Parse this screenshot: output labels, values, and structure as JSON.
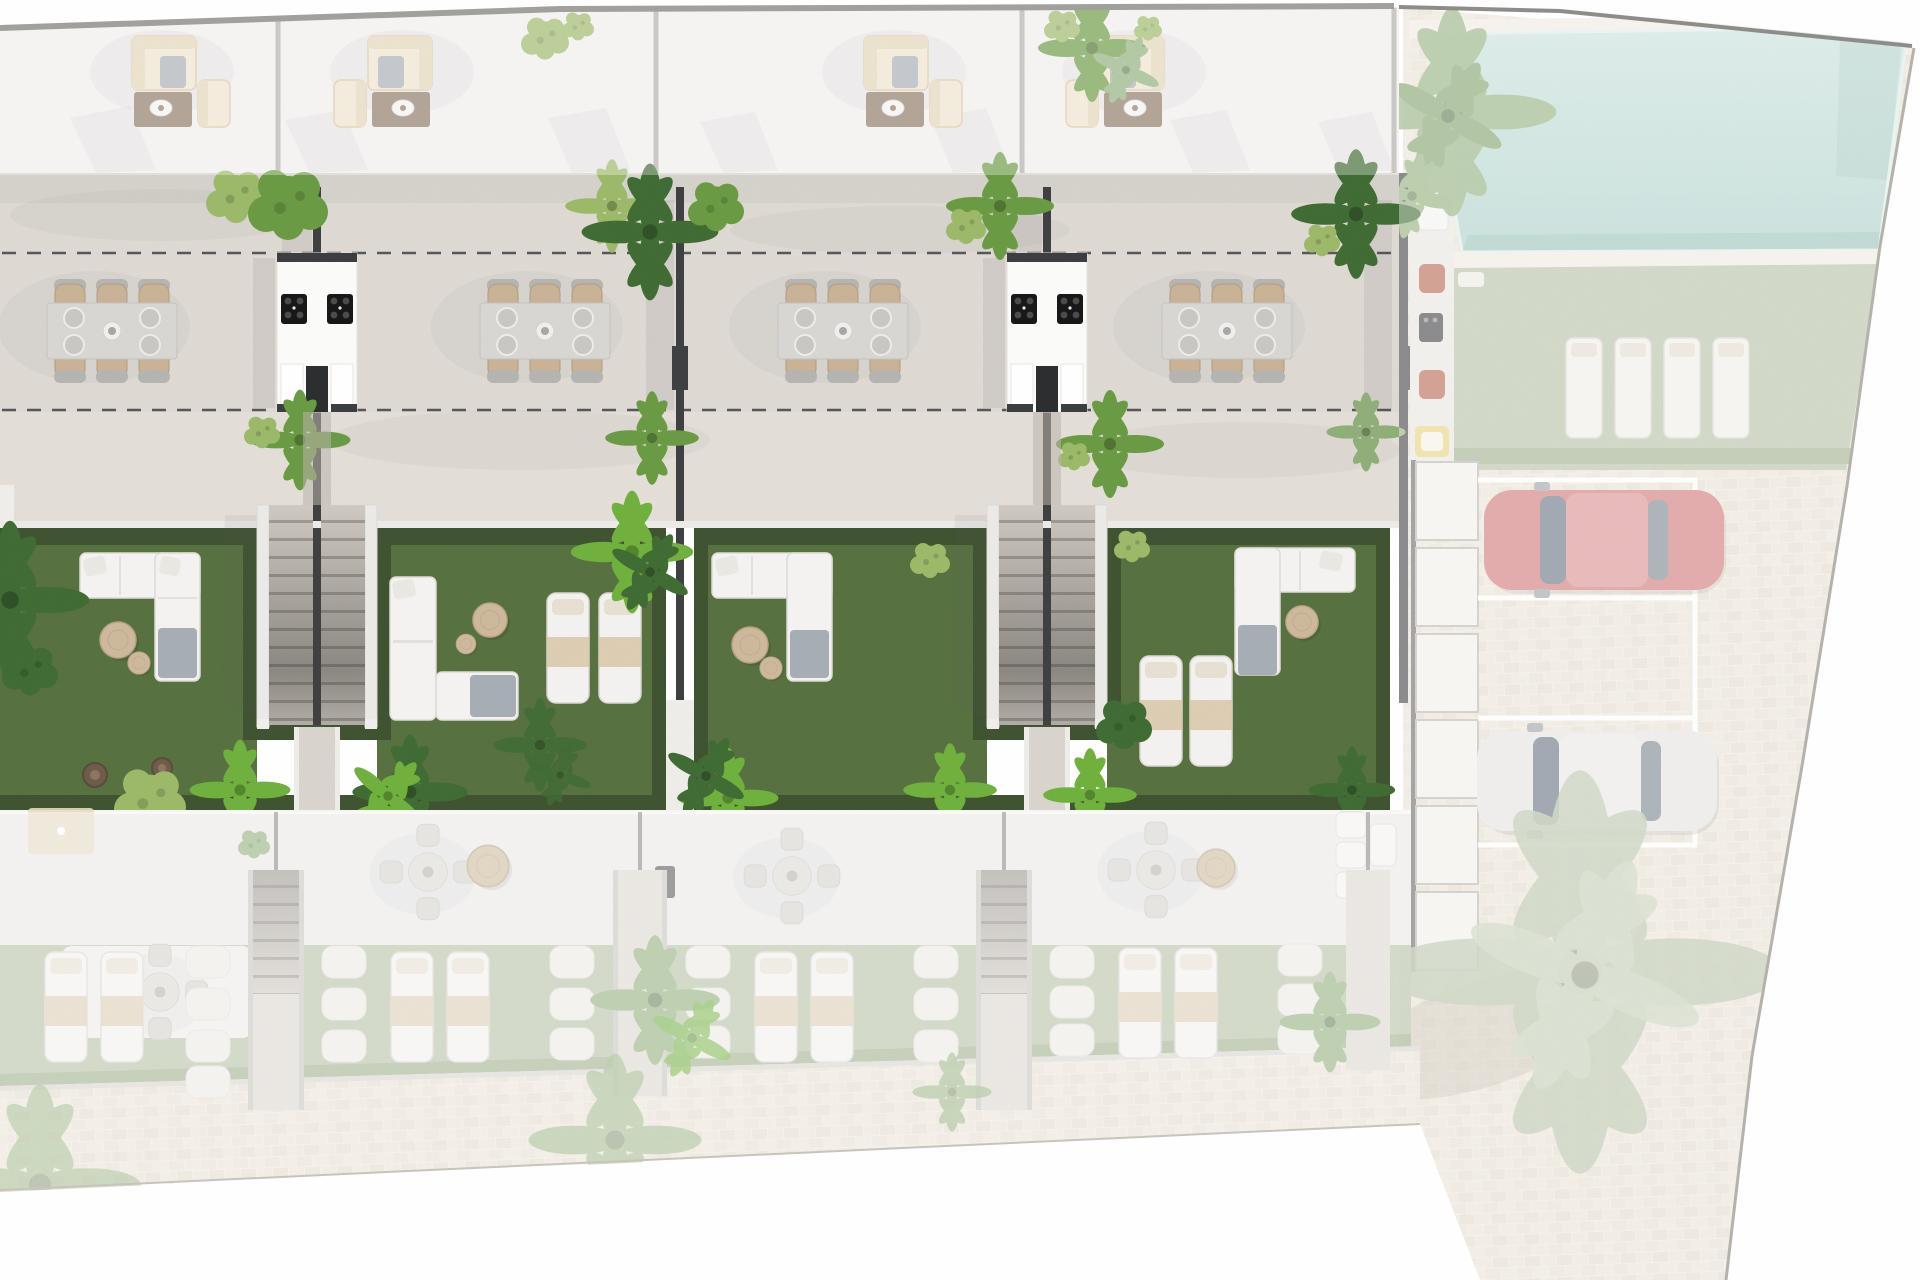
{
  "scene": {
    "type": "architectural site plan, top-down 3D render",
    "focus": "row of townhouse gardens shown in full colour; roof level, neighbouring lower row, pool and parking area shown faded",
    "counts": {
      "townhouse_units_visible": 4,
      "roof_lounge_sets": 4,
      "terrace_dining_sets": 4,
      "chairs_per_dining_set": 6,
      "shared_outdoor_kitchens": 2,
      "garden_staircases": 2,
      "private_gardens": 4,
      "pools": 1,
      "pool_lawn_loungers": 4,
      "parked_cars": 2,
      "parking_bays": 4,
      "lower_row_dining_sets": 4,
      "lower_row_lounger_pairs": 4,
      "storage_boxes": 6
    },
    "cars": [
      {
        "name": "red-car",
        "color_key": "car_red"
      },
      {
        "name": "white-car",
        "color_key": "car_white"
      }
    ]
  },
  "palette": {
    "roof": "#f1efec",
    "terrace": "#ded9d2",
    "terrace_light": "#e3deD7",
    "lawn": "#57703f",
    "hedge": "#3f5230",
    "lawn_pale": "#b6c0a3",
    "hedge_pale": "#9fae8a",
    "pool": "#bcdcd5",
    "pool_deep": "#9cc4bc",
    "paving": "#efe9df",
    "wall_dark": "#3e3f41",
    "line_gray": "#b1afab",
    "dash": "#55555a",
    "white_furniture": "#f4f3f1",
    "beige_seat": "#c9b396",
    "beige_sofa": "#efe5cf",
    "table_gray": "#d8d6d2",
    "coffee_brown": "#8e7a66",
    "pot_brown": "#6e5b49",
    "stone": "#edebe6",
    "deck": "#f0ece4",
    "step_light": "#cfc9c1",
    "step_line": "#a29d96",
    "car_red": "#dd7d7d",
    "car_white": "#f1f0ee",
    "glass": "#6d7882",
    "plant_green": "#6a9a43",
    "plant_dark": "#3f6b33",
    "plant_light": "#9cb969",
    "plant_bright": "#6fb03c",
    "plant_sage": "#8fae79",
    "palm_faded": "#b3c0a4"
  }
}
